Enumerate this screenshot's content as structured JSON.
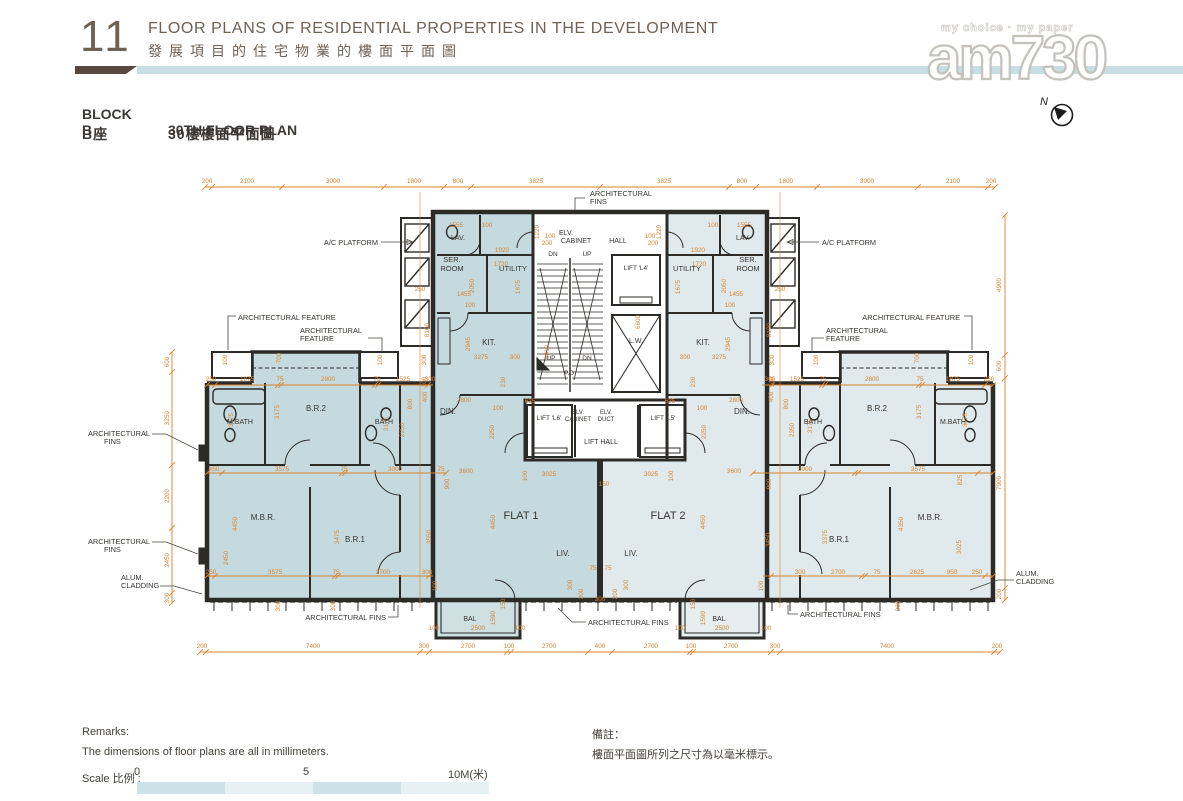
{
  "page": {
    "number": "11",
    "title_en": "FLOOR PLANS OF RESIDENTIAL PROPERTIES IN THE DEVELOPMENT",
    "title_zh": "發展項目的住宅物業的樓面平面圖"
  },
  "block": {
    "name_en": "BLOCK B",
    "plan_en": "30TH FLOOR PLAN",
    "name_zh": "B座",
    "plan_zh": "30樓樓面平面圖"
  },
  "watermark": {
    "tagline": "my choice · my paper",
    "logo": "am730"
  },
  "compass": {
    "label": "N"
  },
  "remarks": {
    "title_en": "Remarks:",
    "body_en": "The dimensions of floor plans are all in millimeters.",
    "title_zh": "備註：",
    "body_zh": "樓面平面圖所列之尺寸為以毫米標示。"
  },
  "scale": {
    "label": "Scale 比例 :",
    "t0": "0",
    "t5": "5",
    "t10": "10M(米)"
  },
  "colors": {
    "dimension": "#d9832d",
    "wall": "#2d2b28",
    "flat1_fill": "#c5dade",
    "flat2_fill": "#e0eaec",
    "divider_chip": "#57483f",
    "divider_bar": "#c7dee2",
    "header_text": "#6e6156"
  },
  "plan": {
    "rooms": [
      [
        "FLAT 1",
        521,
        519,
        11
      ],
      [
        "FLAT 2",
        668,
        519,
        11
      ],
      [
        "LIV.",
        563,
        556,
        8
      ],
      [
        "LIV.",
        631,
        556,
        8
      ],
      [
        "DIN.",
        448,
        414,
        8
      ],
      [
        "DIN.",
        742,
        414,
        8
      ],
      [
        "KIT.",
        489,
        345,
        8
      ],
      [
        "KIT.",
        703,
        345,
        8
      ],
      [
        "UTILITY",
        513,
        271,
        7.5
      ],
      [
        "UTILITY",
        687,
        271,
        7.5
      ],
      [
        "SER.",
        452,
        262,
        7.5
      ],
      [
        "ROOM",
        452,
        271,
        7.5
      ],
      [
        "SER.",
        748,
        262,
        7.5
      ],
      [
        "ROOM",
        748,
        271,
        7.5
      ],
      [
        "LAV.",
        458,
        240,
        7
      ],
      [
        "LAV.",
        743,
        240,
        7
      ],
      [
        "M.BATH",
        240,
        424,
        7
      ],
      [
        "M.BATH",
        953,
        424,
        7
      ],
      [
        "B.R.2",
        316,
        411,
        8
      ],
      [
        "B.R.2",
        877,
        411,
        8
      ],
      [
        "BATH",
        384,
        424,
        7
      ],
      [
        "BATH",
        813,
        424,
        7
      ],
      [
        "M.B.R.",
        263,
        520,
        8
      ],
      [
        "M.B.R.",
        930,
        520,
        8
      ],
      [
        "B.R.1",
        355,
        542,
        8
      ],
      [
        "B.R.1",
        839,
        542,
        8
      ],
      [
        "BAL",
        470,
        621,
        7
      ],
      [
        "BAL",
        719,
        621,
        7
      ],
      [
        "HALL",
        618,
        243,
        7
      ],
      [
        "ELV.",
        566,
        235,
        7
      ],
      [
        "CABINET",
        576,
        243,
        7
      ],
      [
        "DN",
        553,
        256,
        6.5
      ],
      [
        "UP",
        587,
        256,
        6.5
      ],
      [
        "UP",
        551,
        360,
        6.5
      ],
      [
        "DN",
        587,
        360,
        6.5
      ],
      [
        "LIFT 'L4'",
        636,
        270,
        6.5
      ],
      [
        "L.W.",
        636,
        343,
        7
      ],
      [
        "P.D.",
        570,
        375,
        6.5
      ],
      [
        "LIFT 'L6'",
        549,
        420,
        6.5
      ],
      [
        "LIFT 'L5'",
        663,
        420,
        6.5
      ],
      [
        "ELV.",
        578,
        414,
        6
      ],
      [
        "CABINET",
        578,
        421,
        6
      ],
      [
        "ELV.",
        606,
        414,
        6
      ],
      [
        "DUCT",
        606,
        421,
        6
      ],
      [
        "LIFT HALL",
        601,
        444,
        7
      ]
    ],
    "callouts": [
      [
        "ARCHITECTURAL",
        590,
        196,
        "s"
      ],
      [
        "FINS",
        590,
        204,
        "s"
      ],
      [
        "A/C PLATFORM",
        378,
        245,
        "e"
      ],
      [
        "A/C PLATFORM",
        822,
        245,
        "s"
      ],
      [
        "ARCHITECTURAL FEATURE",
        238,
        320,
        "s"
      ],
      [
        "ARCHITECTURAL",
        300,
        333,
        "s"
      ],
      [
        "FEATURE",
        300,
        341,
        "s"
      ],
      [
        "ARCHITECTURAL FEATURE",
        960,
        320,
        "e"
      ],
      [
        "ARCHITECTURAL",
        826,
        333,
        "s"
      ],
      [
        "FEATURE",
        826,
        341,
        "s"
      ],
      [
        "ARCHITECTURAL",
        150,
        436,
        "e"
      ],
      [
        "FINS",
        104,
        444,
        "s"
      ],
      [
        "ARCHITECTURAL",
        150,
        544,
        "e"
      ],
      [
        "FINS",
        104,
        552,
        "s"
      ],
      [
        "ALUM.",
        121,
        580,
        "s"
      ],
      [
        "CLADDING",
        121,
        588,
        "s"
      ],
      [
        "ALUM.",
        1016,
        576,
        "s"
      ],
      [
        "CLADDING",
        1016,
        584,
        "s"
      ],
      [
        "ARCHITECTURAL FINS",
        386,
        620,
        "e"
      ],
      [
        "ARCHITECTURAL FINS",
        588,
        625,
        "s"
      ],
      [
        "ARCHITECTURAL FINS",
        800,
        617,
        "s"
      ]
    ],
    "dims": [
      [
        "200",
        207,
        183
      ],
      [
        "2100",
        247,
        183
      ],
      [
        "3000",
        333,
        183
      ],
      [
        "1800",
        414,
        183
      ],
      [
        "800",
        458,
        183
      ],
      [
        "3825",
        536,
        183
      ],
      [
        "3825",
        664,
        183
      ],
      [
        "800",
        742,
        183
      ],
      [
        "1800",
        786,
        183
      ],
      [
        "3000",
        867,
        183
      ],
      [
        "2100",
        953,
        183
      ],
      [
        "200",
        991,
        183
      ],
      [
        "200",
        202,
        648
      ],
      [
        "7400",
        313,
        648
      ],
      [
        "300",
        424,
        648
      ],
      [
        "2700",
        468,
        648
      ],
      [
        "100",
        509,
        648
      ],
      [
        "2700",
        549,
        648
      ],
      [
        "400",
        600,
        648
      ],
      [
        "2700",
        651,
        648
      ],
      [
        "100",
        691,
        648
      ],
      [
        "2700",
        731,
        648
      ],
      [
        "300",
        775,
        648
      ],
      [
        "7400",
        887,
        648
      ],
      [
        "200",
        997,
        648
      ],
      [
        "600",
        169,
        362,
        1
      ],
      [
        "3250",
        169,
        418,
        1
      ],
      [
        "2200",
        169,
        496,
        1
      ],
      [
        "2450",
        169,
        560,
        1
      ],
      [
        "300",
        169,
        598,
        1
      ],
      [
        "4900",
        1001,
        285,
        1
      ],
      [
        "600",
        1001,
        366,
        1
      ],
      [
        "7900",
        1001,
        483,
        1
      ],
      [
        "200",
        1001,
        594,
        1
      ],
      [
        "250",
        211,
        381
      ],
      [
        "1875",
        247,
        381
      ],
      [
        "75",
        280,
        381
      ],
      [
        "2800",
        328,
        381
      ],
      [
        "75",
        377,
        381
      ],
      [
        "1525",
        403,
        381
      ],
      [
        "300",
        430,
        381
      ],
      [
        "300",
        770,
        381
      ],
      [
        "1525",
        797,
        381
      ],
      [
        "75",
        823,
        381
      ],
      [
        "2800",
        872,
        381
      ],
      [
        "75",
        920,
        381
      ],
      [
        "1875",
        953,
        381
      ],
      [
        "250",
        989,
        381
      ],
      [
        "450",
        214,
        471
      ],
      [
        "3575",
        282,
        471
      ],
      [
        "75",
        344,
        471
      ],
      [
        "3000",
        395,
        471
      ],
      [
        "75",
        441,
        471
      ],
      [
        "900",
        449,
        484,
        1
      ],
      [
        "900",
        771,
        484,
        1
      ],
      [
        "3000",
        805,
        471
      ],
      [
        "3575",
        918,
        471
      ],
      [
        "825",
        962,
        480,
        1
      ],
      [
        "250",
        211,
        574
      ],
      [
        "3575",
        275,
        574
      ],
      [
        "75",
        336,
        574
      ],
      [
        "2700",
        383,
        574
      ],
      [
        "300",
        427,
        574
      ],
      [
        "300",
        800,
        574
      ],
      [
        "2700",
        838,
        574
      ],
      [
        "75",
        877,
        574
      ],
      [
        "2625",
        917,
        574
      ],
      [
        "950",
        952,
        574
      ],
      [
        "250",
        977,
        574
      ],
      [
        "3175",
        233,
        420,
        1
      ],
      [
        "3175",
        279,
        412,
        1
      ],
      [
        "3175",
        388,
        424,
        1
      ],
      [
        "2250",
        404,
        430,
        1
      ],
      [
        "800",
        412,
        404,
        1
      ],
      [
        "100",
        227,
        360,
        1
      ],
      [
        "700",
        281,
        358,
        1
      ],
      [
        "100",
        382,
        360,
        1
      ],
      [
        "3175",
        967,
        420,
        1
      ],
      [
        "3175",
        921,
        412,
        1
      ],
      [
        "3175",
        812,
        426,
        1
      ],
      [
        "2350",
        794,
        430,
        1
      ],
      [
        "800",
        788,
        404,
        1
      ],
      [
        "100",
        973,
        360,
        1
      ],
      [
        "700",
        919,
        358,
        1
      ],
      [
        "100",
        818,
        360,
        1
      ],
      [
        "4450",
        237,
        524,
        1
      ],
      [
        "2450",
        228,
        558,
        1
      ],
      [
        "3475",
        339,
        537,
        1
      ],
      [
        "3550",
        431,
        537,
        1
      ],
      [
        "4350",
        903,
        524,
        1
      ],
      [
        "3025",
        961,
        547,
        1
      ],
      [
        "3375",
        827,
        537,
        1
      ],
      [
        "3450",
        770,
        540,
        1
      ],
      [
        "3600",
        466,
        473
      ],
      [
        "3025",
        549,
        476
      ],
      [
        "100",
        527,
        476,
        1
      ],
      [
        "4450",
        495,
        522,
        1
      ],
      [
        "150",
        604,
        486
      ],
      [
        "3600",
        734,
        473
      ],
      [
        "3025",
        651,
        476
      ],
      [
        "100",
        673,
        476,
        1
      ],
      [
        "4450",
        705,
        522,
        1
      ],
      [
        "75",
        593,
        570
      ],
      [
        "75",
        608,
        570
      ],
      [
        "300",
        572,
        585,
        1
      ],
      [
        "300",
        628,
        585,
        1
      ],
      [
        "200",
        583,
        594,
        1
      ],
      [
        "200",
        617,
        594,
        1
      ],
      [
        "300",
        600,
        601
      ],
      [
        "100",
        437,
        586,
        1
      ],
      [
        "150",
        505,
        604,
        1
      ],
      [
        "1590",
        495,
        618,
        1
      ],
      [
        "100",
        434,
        630
      ],
      [
        "2500",
        478,
        630
      ],
      [
        "100",
        520,
        630
      ],
      [
        "300",
        280,
        606,
        1
      ],
      [
        "300",
        335,
        606,
        1
      ],
      [
        "100",
        763,
        586,
        1
      ],
      [
        "150",
        695,
        604,
        1
      ],
      [
        "1590",
        705,
        618,
        1
      ],
      [
        "100",
        680,
        630
      ],
      [
        "2500",
        722,
        630
      ],
      [
        "100",
        766,
        630
      ],
      [
        "300",
        900,
        606,
        1
      ],
      [
        "1555",
        456,
        227
      ],
      [
        "100",
        487,
        227
      ],
      [
        "1920",
        502,
        252
      ],
      [
        "1720",
        501,
        266
      ],
      [
        "2050",
        474,
        286,
        1
      ],
      [
        "1675",
        520,
        287,
        1
      ],
      [
        "1455",
        464,
        296
      ],
      [
        "100",
        470,
        307
      ],
      [
        "2945",
        470,
        344,
        1
      ],
      [
        "3275",
        481,
        359
      ],
      [
        "300",
        515,
        359
      ],
      [
        "2800",
        464,
        402
      ],
      [
        "100",
        498,
        410
      ],
      [
        "2250",
        494,
        432,
        1
      ],
      [
        "230",
        505,
        382,
        1
      ],
      [
        "625",
        530,
        403
      ],
      [
        "1555",
        744,
        227
      ],
      [
        "100",
        713,
        227
      ],
      [
        "1920",
        698,
        252
      ],
      [
        "1720",
        699,
        266
      ],
      [
        "2050",
        726,
        286,
        1
      ],
      [
        "1675",
        680,
        287,
        1
      ],
      [
        "1455",
        736,
        296
      ],
      [
        "100",
        730,
        307
      ],
      [
        "2945",
        730,
        344,
        1
      ],
      [
        "3275",
        719,
        359
      ],
      [
        "300",
        685,
        359
      ],
      [
        "2800",
        736,
        402
      ],
      [
        "100",
        702,
        410
      ],
      [
        "2250",
        706,
        432,
        1
      ],
      [
        "230",
        695,
        382,
        1
      ],
      [
        "625",
        670,
        403
      ],
      [
        "6600",
        640,
        322,
        1
      ],
      [
        "6810",
        549,
        352,
        1
      ],
      [
        "1220",
        539,
        232,
        1
      ],
      [
        "1220",
        661,
        232,
        1
      ],
      [
        "100",
        550,
        238
      ],
      [
        "200",
        547,
        245
      ],
      [
        "100",
        650,
        238
      ],
      [
        "200",
        653,
        245
      ],
      [
        "250",
        420,
        291
      ],
      [
        "250",
        780,
        291
      ],
      [
        "8100",
        429,
        330,
        1
      ],
      [
        "8100",
        771,
        330,
        1
      ],
      [
        "300",
        774,
        360,
        1
      ],
      [
        "100",
        774,
        382,
        1
      ],
      [
        "400",
        773,
        397,
        1
      ],
      [
        "300",
        426,
        360,
        1
      ],
      [
        "100",
        426,
        382,
        1
      ],
      [
        "400",
        427,
        397,
        1
      ]
    ]
  }
}
